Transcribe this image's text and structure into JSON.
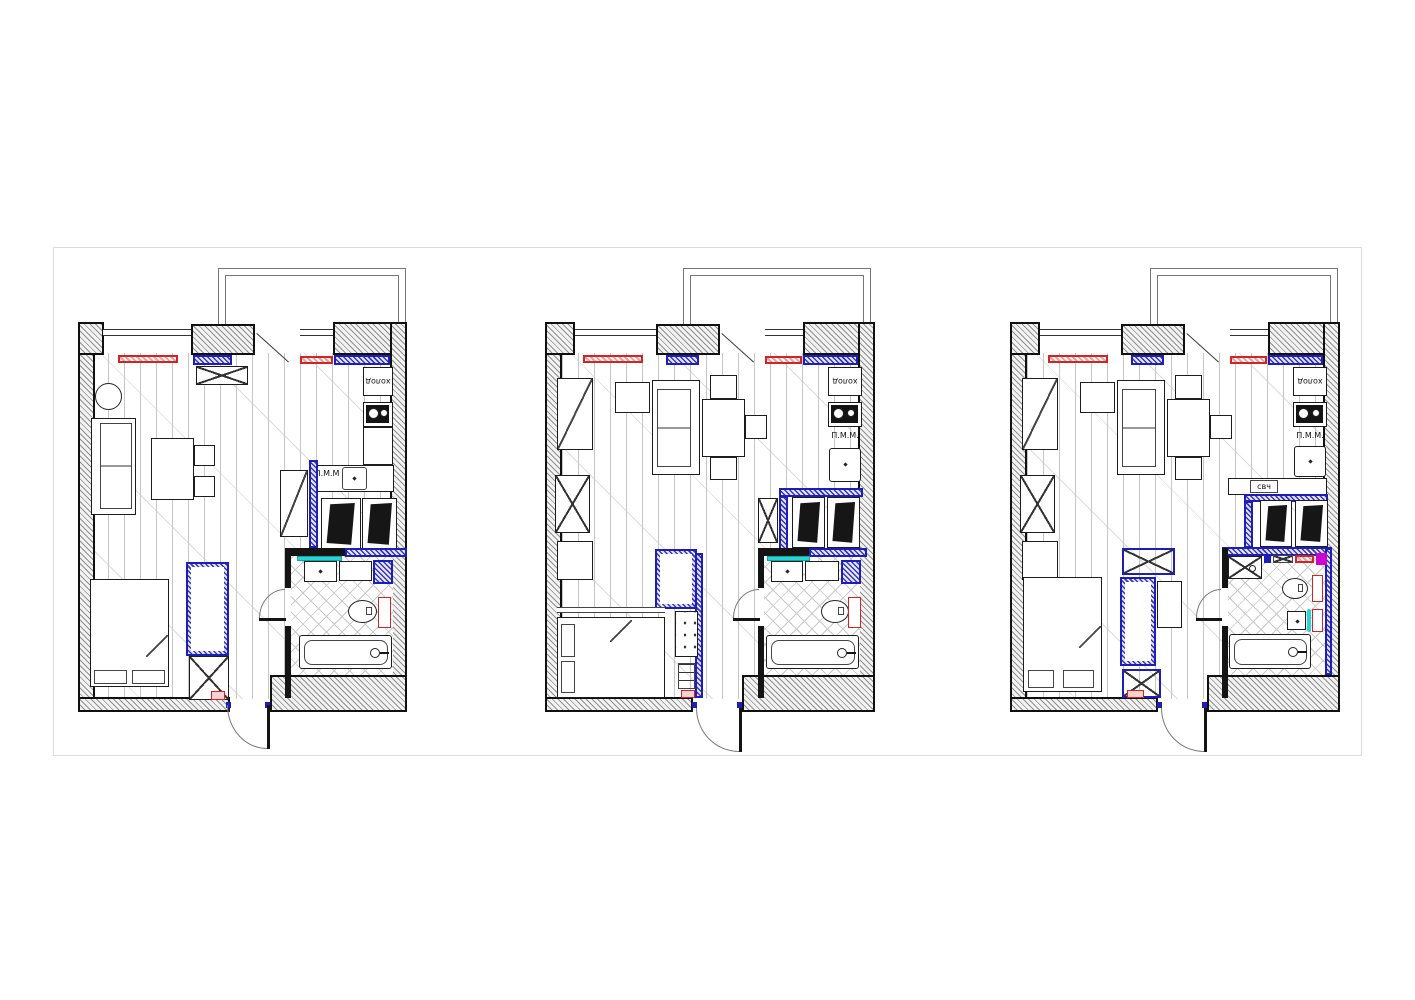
{
  "drawing": {
    "kind": "apartment renovation floor plan, three layout variants",
    "background": "#ffffff",
    "frame_color": "#dcdcdc"
  },
  "colors": {
    "wall_border": "#101010",
    "wall_hatch": "#8f8f8f",
    "partition_blue": "#1d1db8",
    "accent_red": "#d42323",
    "accent_cyan": "#2bd4d4",
    "accent_magenta": "#cc06cc",
    "floor_line": "#c6c6c6"
  },
  "plans": [
    {
      "name": "variant-1",
      "labels": {
        "fridge": "холод",
        "dishwasher": "П.М.М"
      }
    },
    {
      "name": "variant-2",
      "labels": {
        "fridge": "холод",
        "dishwasher": "П.М.М."
      }
    },
    {
      "name": "variant-3",
      "labels": {
        "fridge": "холод",
        "dishwasher": "П.М.М.",
        "microwave": "свч"
      }
    }
  ]
}
